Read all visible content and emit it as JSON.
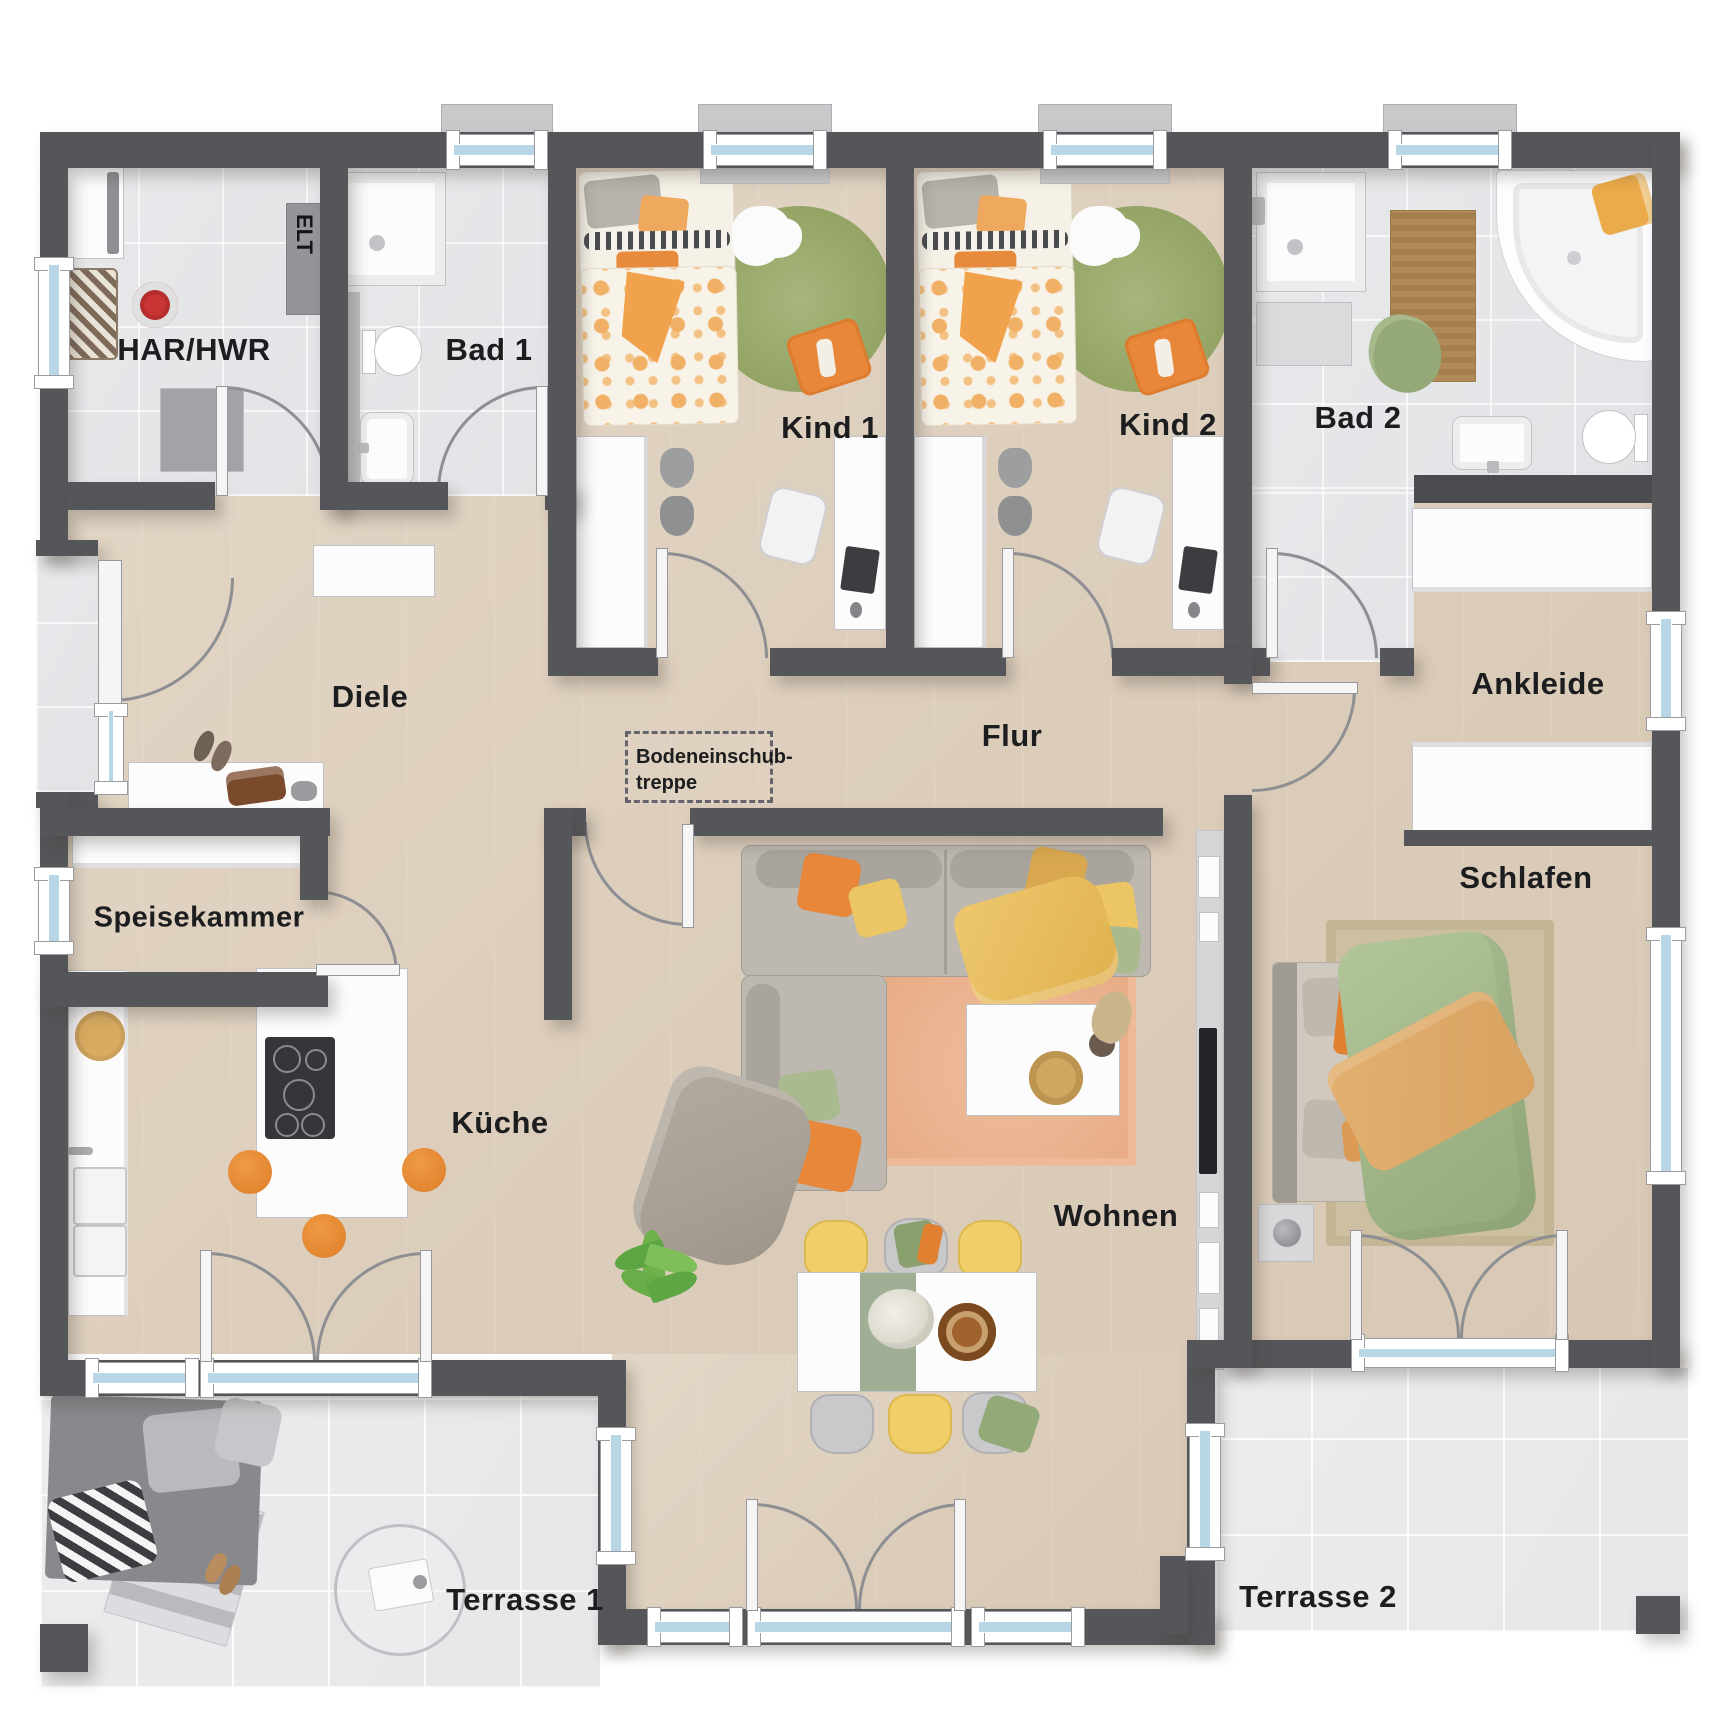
{
  "plan": {
    "rooms": [
      {
        "id": "har-hwr",
        "label": "HAR/HWR"
      },
      {
        "id": "bad-1",
        "label": "Bad 1"
      },
      {
        "id": "kind-1",
        "label": "Kind 1"
      },
      {
        "id": "kind-2",
        "label": "Kind 2"
      },
      {
        "id": "bad-2",
        "label": "Bad 2"
      },
      {
        "id": "diele",
        "label": "Diele"
      },
      {
        "id": "flur",
        "label": "Flur"
      },
      {
        "id": "ankleide",
        "label": "Ankleide"
      },
      {
        "id": "schlafen",
        "label": "Schlafen"
      },
      {
        "id": "speisekammer",
        "label": "Speisekammer"
      },
      {
        "id": "kueche",
        "label": "Küche"
      },
      {
        "id": "wohnen",
        "label": "Wohnen"
      },
      {
        "id": "terrasse-1",
        "label": "Terrasse 1"
      },
      {
        "id": "terrasse-2",
        "label": "Terrasse 2"
      }
    ],
    "annotations": {
      "elt": "ELT",
      "attic_stairs": [
        "Bodeneinschub-",
        "treppe"
      ]
    },
    "colors": {
      "wall": "#55565a",
      "wood_floor": "#ddcfbf",
      "tile_floor": "#e6e7e9",
      "terrace_floor": "#eaebed",
      "window_glass": "#b9d6e6",
      "accent_orange": "#e8923f",
      "accent_yellow": "#ecc664",
      "accent_green": "#a9bb8e",
      "rug_green": "#9aa96f",
      "rug_peach": "#ecb795",
      "label_text": "#1c1d1f"
    }
  }
}
